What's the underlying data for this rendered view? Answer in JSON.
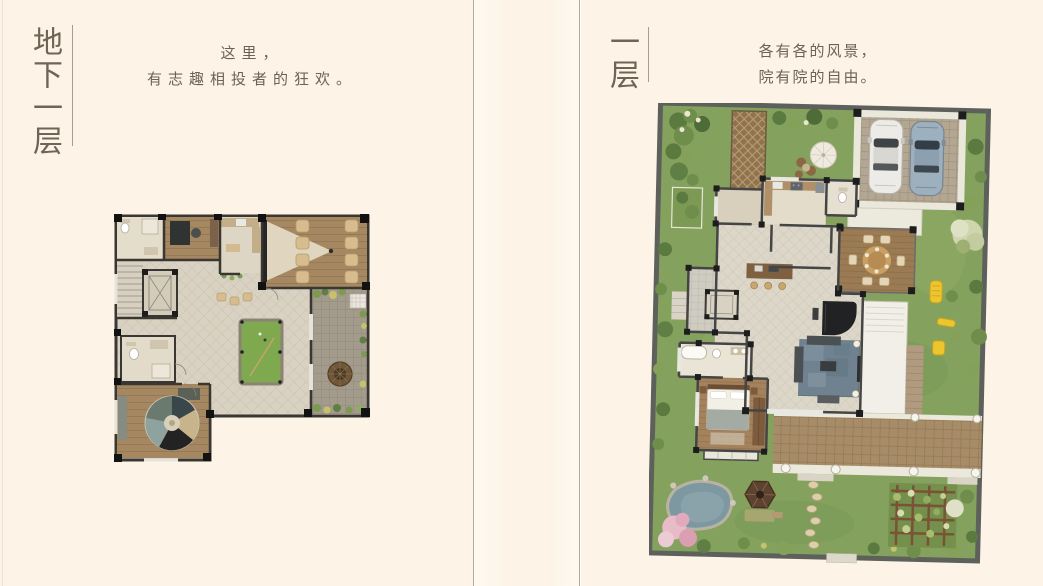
{
  "page": {
    "background_color": "#fdf4e7",
    "divider_color": "#b2a798",
    "text_color": "#6b6357",
    "title_color": "#6e6557"
  },
  "left_page": {
    "floor_title": "地下一层",
    "slogan": [
      "这里，",
      "有志趣相投者的狂欢。"
    ],
    "plan_name": "basement-floor-plan"
  },
  "right_page": {
    "floor_title": "一层",
    "slogan": [
      "各有各的风景，",
      "院有院的自由。"
    ],
    "plan_name": "first-floor-plan"
  },
  "plan_colors": {
    "wall": "#3a3733",
    "tile_floor": "#d9d2c3",
    "wood_floor": "#a58762",
    "billiard_table_green": "#7fa94f",
    "courtyard_paving": "#a39b8c",
    "lawn_green": "#84a25e",
    "shrub_green": "#5a7a40",
    "terrace_paving": "#a78c6a",
    "white_car": "#ecebe7",
    "blue_car": "#9db0be",
    "playground_yellow": "#ecc52f",
    "pond_water": "#7e98a1",
    "blossom_pink": "#e7bcc8",
    "gazebo_brown": "#5d4330"
  }
}
